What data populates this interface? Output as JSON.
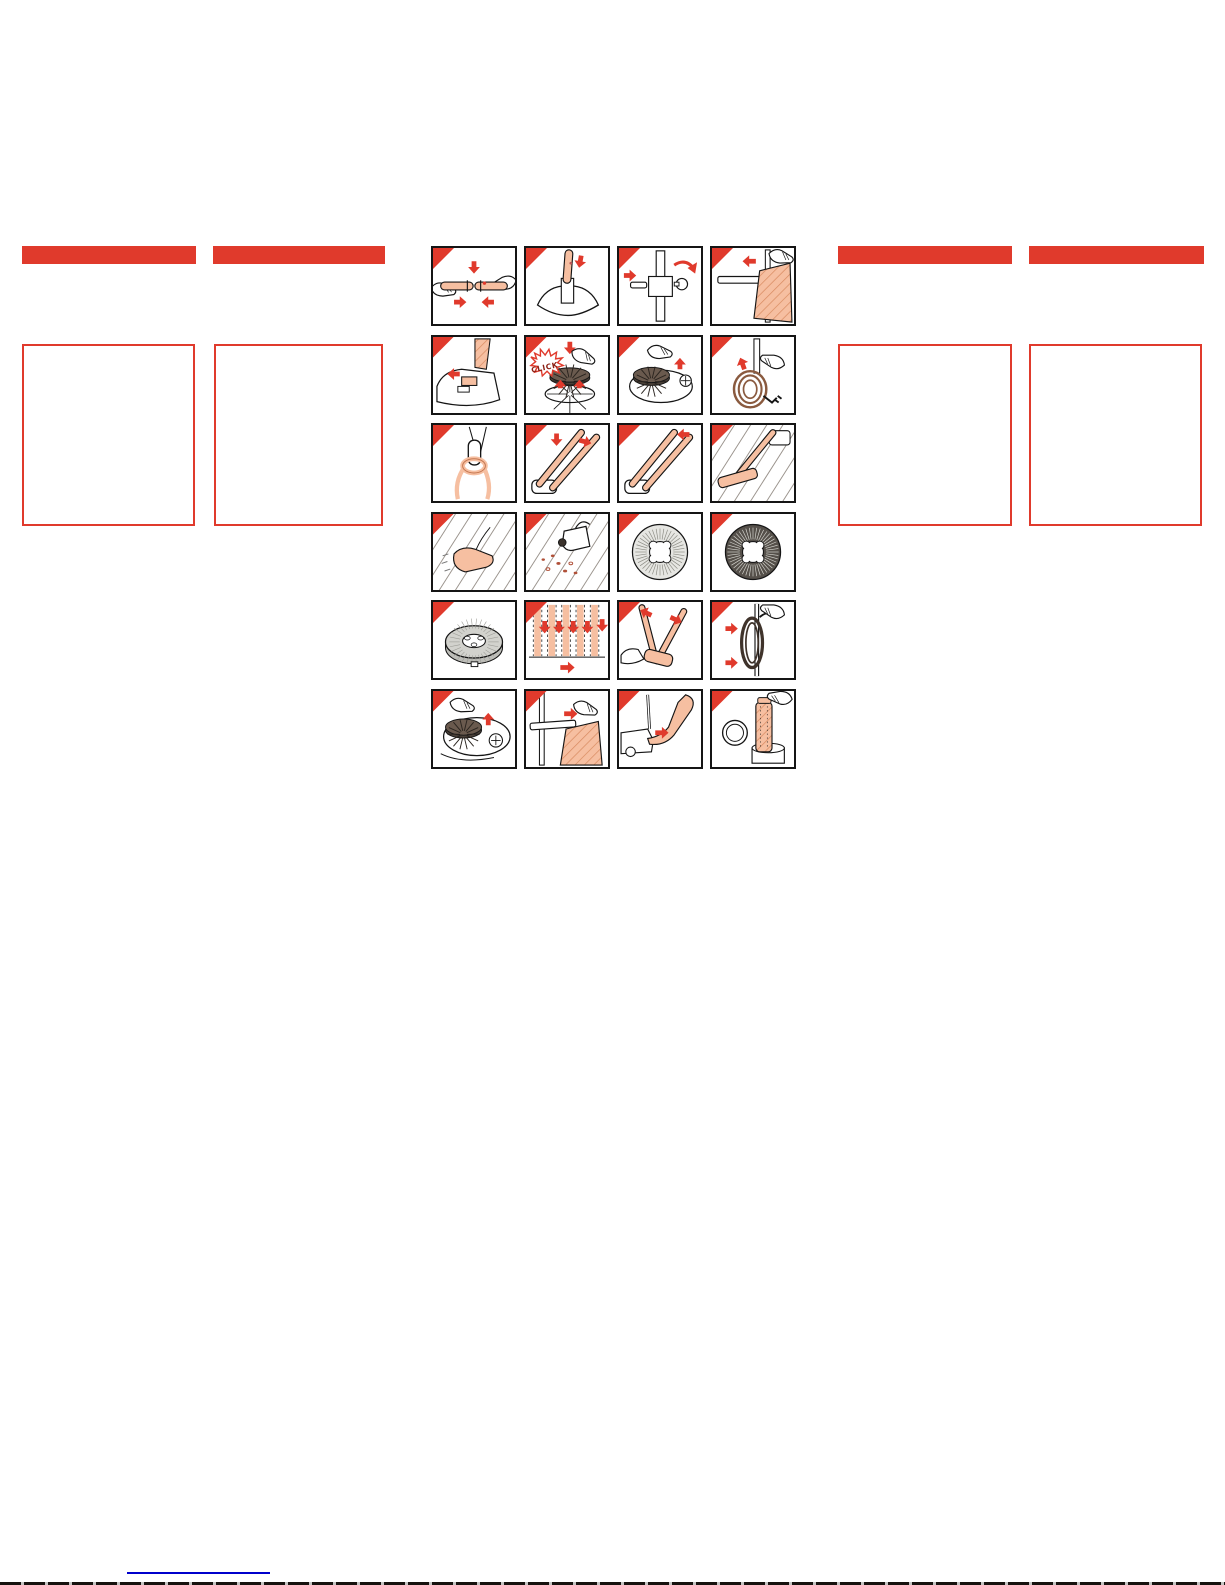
{
  "page": {
    "background": "#ffffff",
    "accent_red": "#e03a2c",
    "peach": "#f6bfa1",
    "line_black": "#151515",
    "link_blue": "#0000cc",
    "cord_brown": "#8a5a3f",
    "pad_gray": "#d2d2cd",
    "brush_dark": "#4a4038",
    "brush_light": "#e6e6e2"
  },
  "instructions": {
    "rows": 6,
    "cols": 4,
    "panels": [
      {
        "step": 1,
        "icon": "join-handle-halves-icon",
        "label": ""
      },
      {
        "step": 2,
        "icon": "insert-handle-into-base-icon",
        "label": ""
      },
      {
        "step": 3,
        "icon": "attach-bolt-and-knob-icon",
        "label": ""
      },
      {
        "step": 4,
        "icon": "slide-bag-onto-tube-icon",
        "label": ""
      },
      {
        "step": 5,
        "icon": "press-release-latch-icon",
        "label": ""
      },
      {
        "step": 6,
        "icon": "click-brush-onto-spindle-icon",
        "label": "CLICK"
      },
      {
        "step": 7,
        "icon": "seat-brush-on-machine-icon",
        "label": ""
      },
      {
        "step": 8,
        "icon": "hang-cord-loop-icon",
        "label": ""
      },
      {
        "step": 9,
        "icon": "cord-ring-on-handle-icon",
        "label": ""
      },
      {
        "step": 10,
        "icon": "unfold-handle-icon",
        "label": ""
      },
      {
        "step": 11,
        "icon": "raise-handle-icon",
        "label": ""
      },
      {
        "step": 12,
        "icon": "polisher-on-wood-floor-icon",
        "label": ""
      },
      {
        "step": 13,
        "icon": "wipe-floor-with-cloth-icon",
        "label": ""
      },
      {
        "step": 14,
        "icon": "apply-polish-to-floor-icon",
        "label": ""
      },
      {
        "step": 15,
        "icon": "light-brush-disc-icon",
        "label": ""
      },
      {
        "step": 16,
        "icon": "dark-brush-disc-icon",
        "label": ""
      },
      {
        "step": 17,
        "icon": "felt-polishing-pad-icon",
        "label": ""
      },
      {
        "step": 18,
        "icon": "overlapping-passes-diagram-icon",
        "label": ""
      },
      {
        "step": 19,
        "icon": "fold-handle-to-floor-icon",
        "label": ""
      },
      {
        "step": 20,
        "icon": "wind-cord-for-storage-icon",
        "label": ""
      },
      {
        "step": 21,
        "icon": "lift-brush-off-machine-icon",
        "label": ""
      },
      {
        "step": 22,
        "icon": "fit-bag-on-tube-icon",
        "label": ""
      },
      {
        "step": 23,
        "icon": "reach-under-machine-icon",
        "label": ""
      },
      {
        "step": 24,
        "icon": "empty-bag-into-bin-icon",
        "label": ""
      }
    ]
  },
  "footer": {
    "link_text": ""
  }
}
